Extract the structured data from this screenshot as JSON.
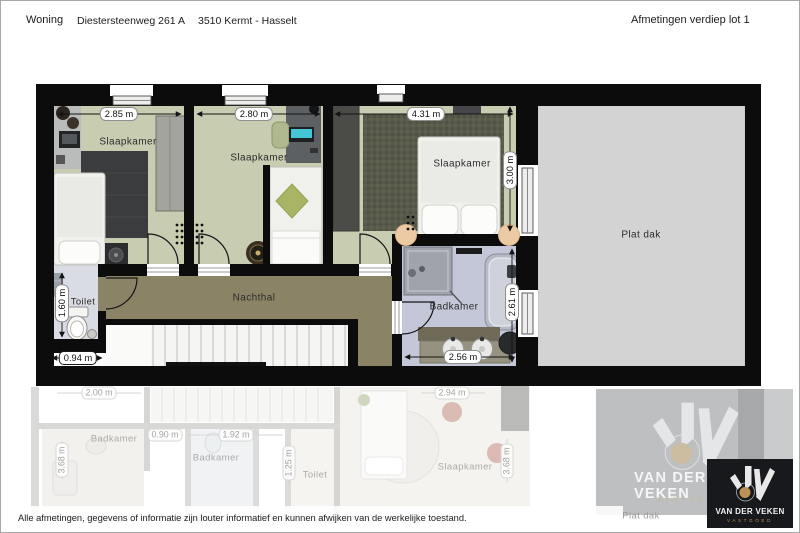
{
  "header": {
    "property_type": "Woning",
    "address": "Diestersteenweg 261 A",
    "city": "3510 Kermt - Hasselt",
    "plan_title": "Afmetingen verdiep lot 1"
  },
  "floor_plan": {
    "rooms": {
      "slaapkamer_left": {
        "name": "Slaapkamer",
        "width": "2.85 m"
      },
      "slaapkamer_mid": {
        "name": "Slaapkamer",
        "width": "2.80 m"
      },
      "slaapkamer_right": {
        "name": "Slaapkamer",
        "width": "4.31 m",
        "depth": "3.00 m"
      },
      "toilet": {
        "name": "Toilet",
        "depth": "1.60 m",
        "width": "0.94 m"
      },
      "nachthal": {
        "name": "Nachthal"
      },
      "badkamer": {
        "name": "Badkamer",
        "width": "2.56 m",
        "depth": "2.61 m"
      },
      "plat_dak": {
        "name": "Plat dak"
      }
    }
  },
  "ground_floor_shadow": {
    "dim_left_width": "2.00 m",
    "badkamer_left": "Badkamer",
    "dim_mid_a": "0.90 m",
    "dim_mid_b": "1.92 m",
    "badkamer_mid": "Badkamer",
    "dim_left_depth": "3.68 m",
    "dim_toilet_depth": "1.25 m",
    "toilet": "Toilet",
    "dim_bedroom_width": "2.94 m",
    "slaapkamer": "Slaapkamer",
    "dim_bedroom_depth": "3.68 m",
    "plat_dak": "Plat dak"
  },
  "branding": {
    "name": "VAN DER VEKEN",
    "tagline": "VASTGOED",
    "gold": "#b8955a",
    "badge_background": "#17191d"
  },
  "footer": {
    "disclaimer": "Alle afmetingen, gegevens of informatie zijn louter informatief en kunnen afwijken van de werkelijke toestand."
  },
  "colors": {
    "wall": "#0c0c0c",
    "bedroom_floor": "#c8ccb0",
    "hall_floor": "#8b8365",
    "bathroom_floor": "#c4c7d8",
    "toilet_floor": "#dadce5",
    "flat_roof": "#d3d3d4"
  }
}
